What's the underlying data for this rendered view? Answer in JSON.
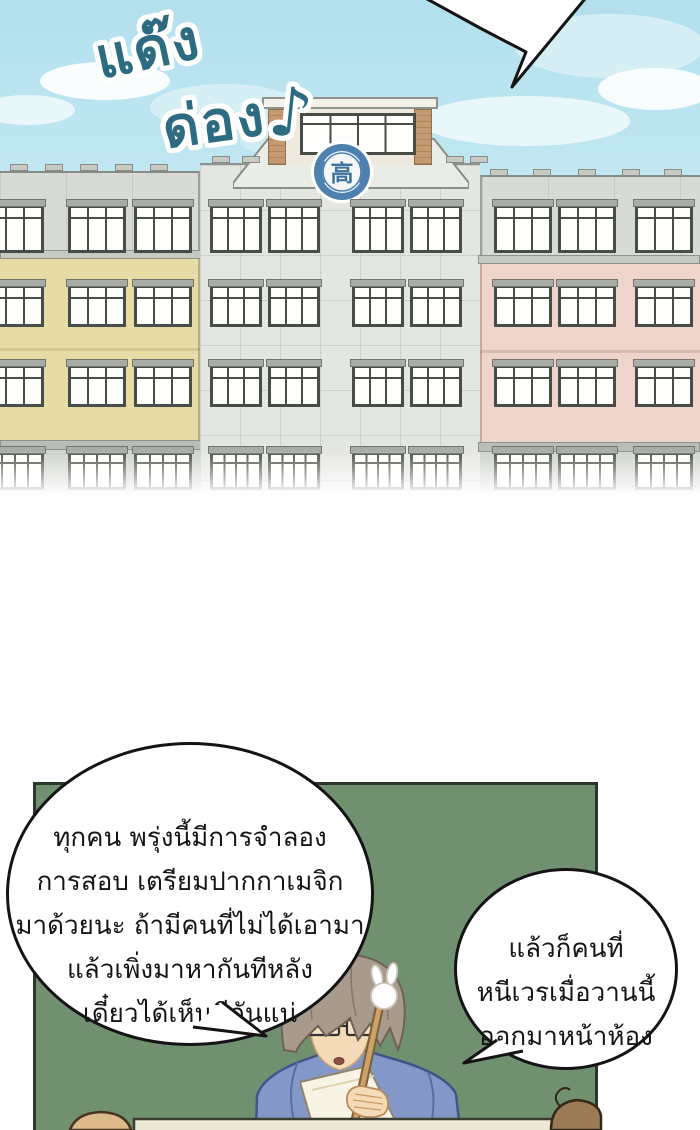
{
  "sfx": {
    "word1": "แด๊ง",
    "word2": "ด่อง",
    "music_note": "♪"
  },
  "building": {
    "emblem_character": "高"
  },
  "speech_bubbles": {
    "teacher_main": {
      "lines": [
        "ทุกคน พรุ่งนี้มีการจำลอง",
        "การสอบ เตรียมปากกาเมจิก",
        "มาด้วยนะ ถ้ามีคนที่ไม่ได้เอามา",
        "แล้วเพิ่งมาหากันทีหลัง",
        "เดี๋ยวได้เห็นดีกันแน่"
      ]
    },
    "teacher_second": {
      "lines": [
        "แล้วก็คนที่",
        "หนีเวรเมื่อวานนี้",
        "ออกมาหน้าห้อง"
      ]
    }
  },
  "colors": {
    "sky": "#b3e0ee",
    "sfx_text": "#2d6b80",
    "chalkboard_green": "#70906f",
    "left_wing_yellow": "#e8dca6",
    "right_wing_pink": "#eed4cb",
    "center_facade_gray": "#e4e6e2",
    "emblem_blue": "#4e81b0",
    "teacher_shirt_blue": "#8397c9",
    "desk_tan": "#ece8d6",
    "speech_text": "#151515"
  }
}
